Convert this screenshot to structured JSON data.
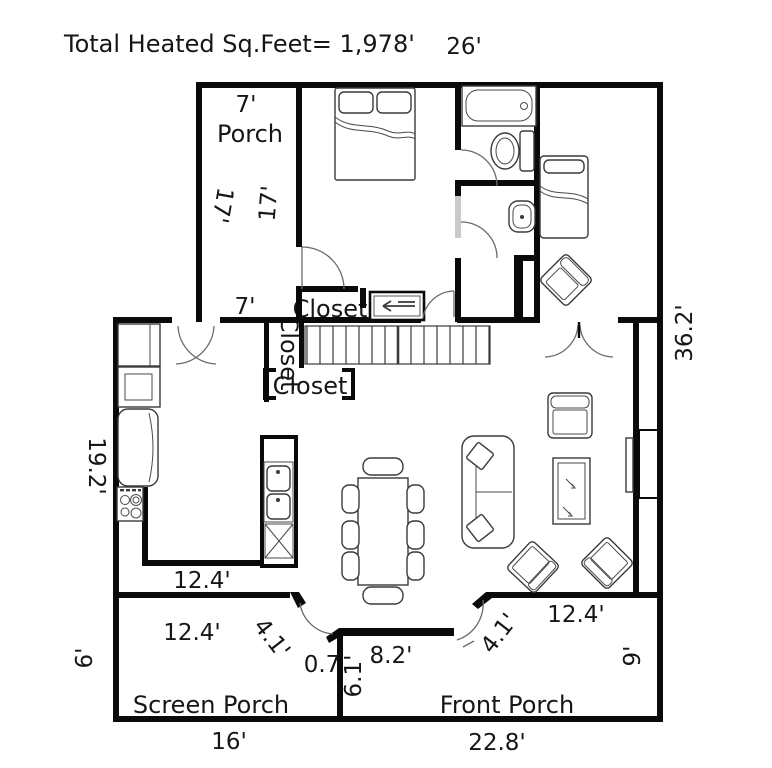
{
  "plan": {
    "title": "Total Heated Sq.Feet= 1,978'",
    "rooms": {
      "porch": "Porch",
      "screen_porch": "Screen Porch",
      "front_porch": "Front Porch",
      "closet_bedroom": "Closet",
      "closet_hall": "Closet",
      "closet_stairs": "Closet"
    },
    "dims": {
      "top_width": "26'",
      "porch_width": "7'",
      "porch_height": "17'",
      "bedroom_height": "17'",
      "porch_width_bottom": "7'",
      "right_side": "36.2'",
      "left_side": "19.2'",
      "kitchen_width": "12.4'",
      "screen_porch_width": "12.4'",
      "screen_porch_depth": "6'",
      "screen_porch_length": "16'",
      "screen_door": "4.1'",
      "entry_jog": "0.7",
      "entry_width": "8.2'",
      "entry_depth": "6.1'",
      "front_door": "4.1'",
      "front_porch_width": "12.4'",
      "front_porch_depth": "9'",
      "front_porch_length": "22.8'"
    }
  }
}
